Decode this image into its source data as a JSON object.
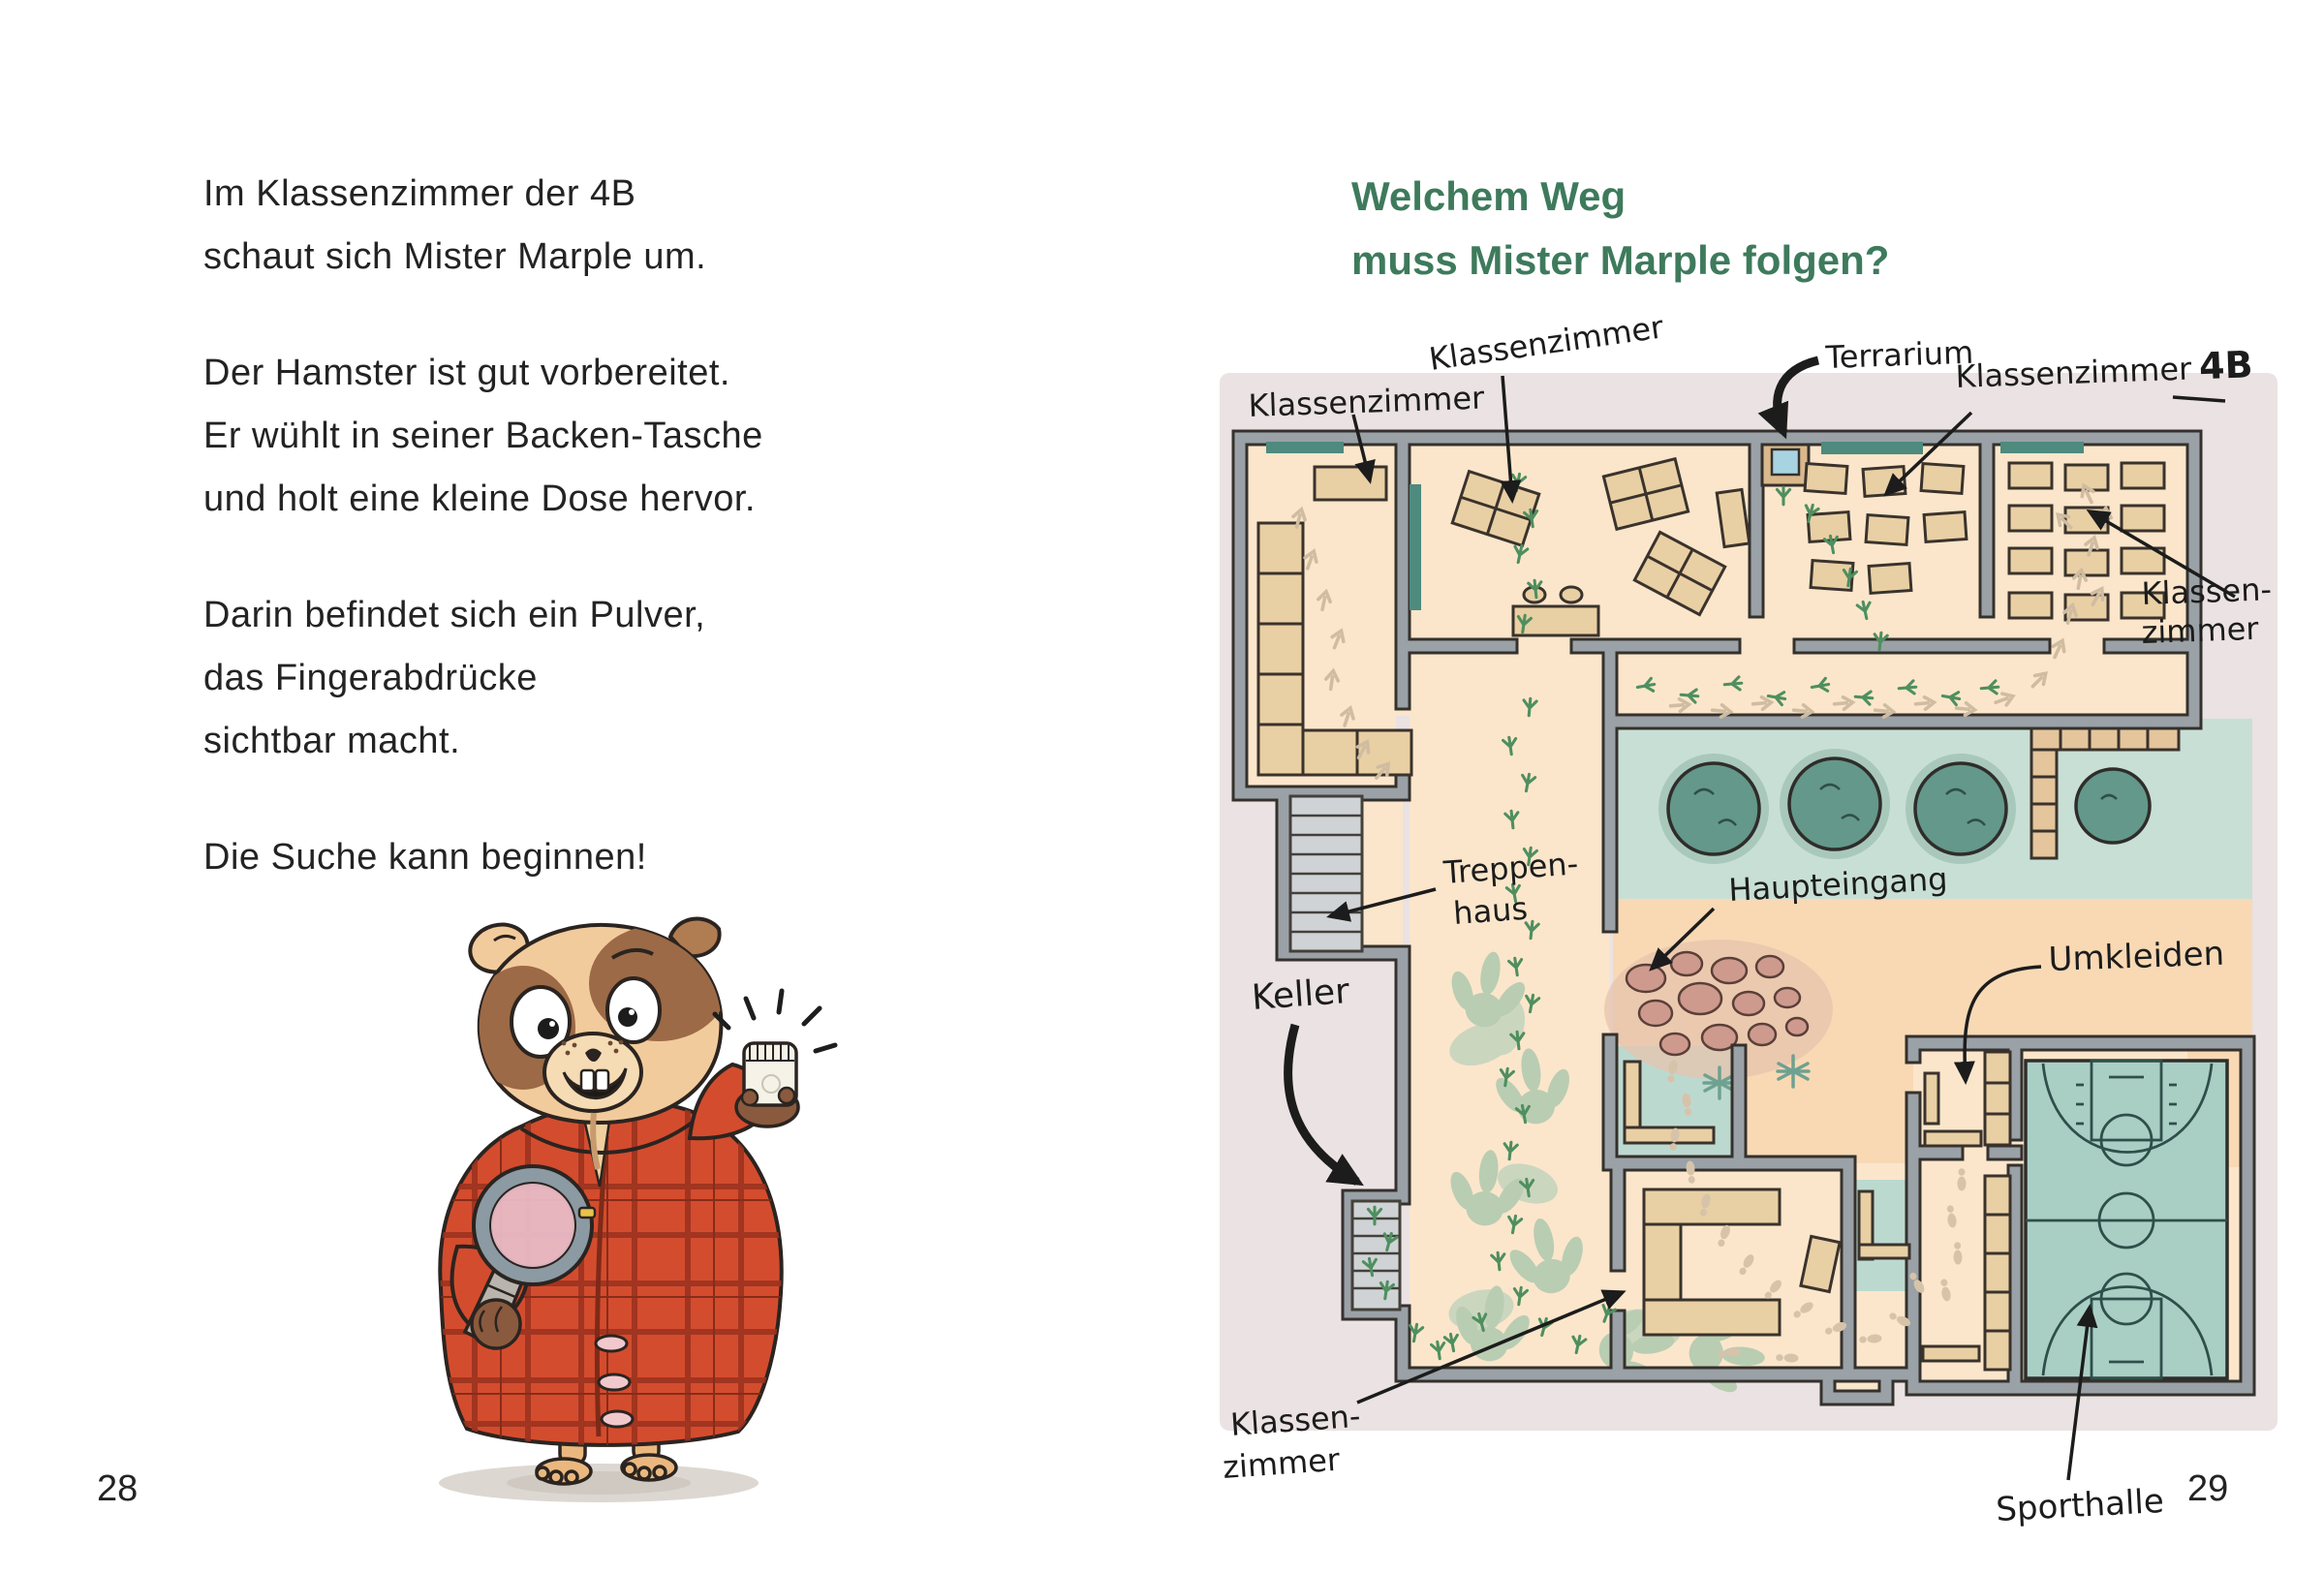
{
  "left_page": {
    "paragraphs": [
      [
        "Im Klassenzimmer der 4B",
        "schaut sich Mister Marple um."
      ],
      [
        "Der Hamster ist gut vorbereitet.",
        "Er wühlt in seiner Backen-Tasche",
        "und holt eine kleine Dose hervor."
      ],
      [
        "Darin befindet sich ein Pulver,",
        "das Fingerabdrücke",
        "sichtbar macht."
      ],
      [
        "Die Suche kann beginnen!"
      ]
    ],
    "page_number": "28"
  },
  "right_page": {
    "heading_line1": "Welchem Weg",
    "heading_line2": "muss Mister Marple folgen?",
    "page_number": "29",
    "map": {
      "label_klassenzimmer_top_left": "Klassenzimmer",
      "label_klassenzimmer_top_mid": "Klassenzimmer",
      "label_terrarium": "Terrarium",
      "label_klassenzimmer_4b_text": "Klassenzimmer",
      "label_klassenzimmer_4b_class": "4B",
      "label_klassen_right_1": "Klassen-",
      "label_klassen_right_2": "zimmer",
      "label_treppen_1": "Treppen-",
      "label_treppen_2": "haus",
      "label_haupteingang": "Haupteingang",
      "label_keller": "Keller",
      "label_umkleiden": "Umkleiden",
      "label_klassen_bottom_1": "Klassen-",
      "label_klassen_bottom_2": "zimmer",
      "label_sporthalle": "Sporthalle"
    }
  },
  "colors": {
    "heading_green": "#3e7a5c",
    "body_text": "#232323",
    "map_paper": "#eae2e3",
    "floor_cream": "#fbe6cb",
    "courtyard_peach": "#f8d9b4",
    "garden_teal": "#c8dfd6",
    "bush_teal": "#63988a",
    "wall_gray": "#9aa1a7",
    "outline_dark": "#35312c",
    "desk_tan": "#e9cfa4",
    "court_teal": "#a9cfc5",
    "stone_pink": "#cf9a8e",
    "footprint_green": "#4f8f5f",
    "footprint_beige": "#cfbca1",
    "dino_sage": "#b9cdb2",
    "coat_red": "#d44c2e",
    "fur_tan": "#f2cb9c"
  }
}
